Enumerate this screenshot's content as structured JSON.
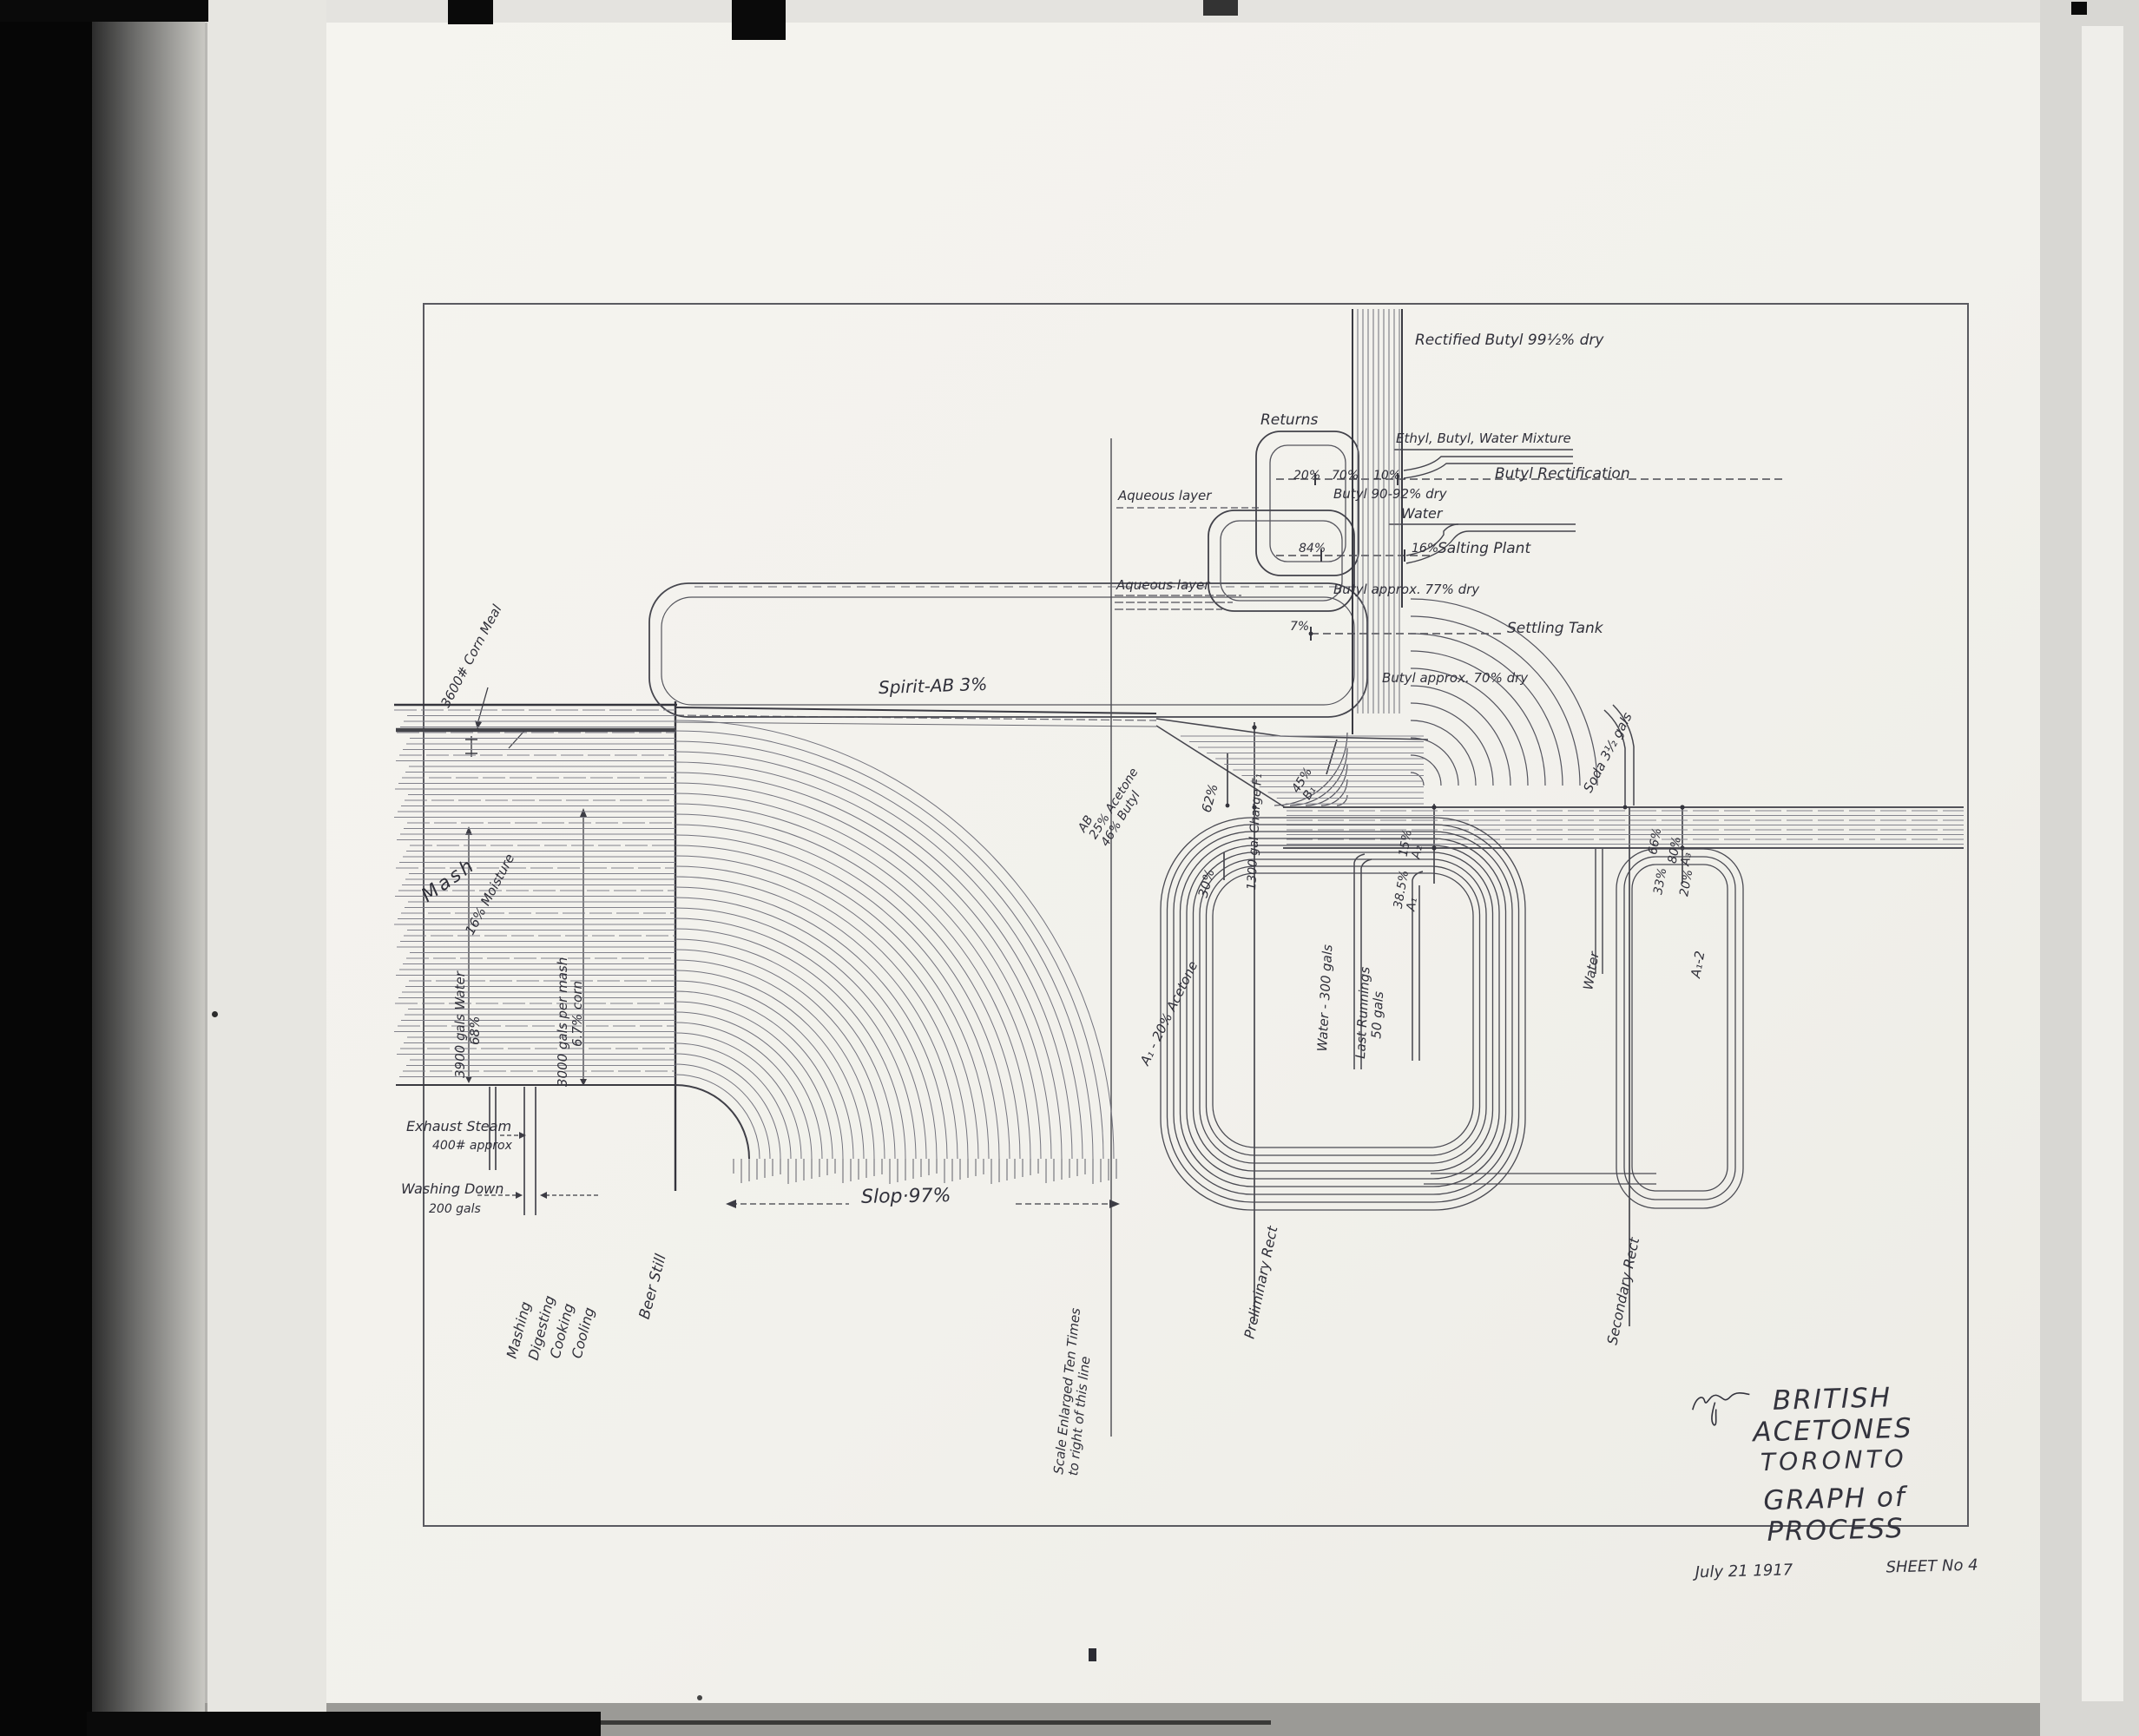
{
  "title_block": {
    "company": "BRITISH ACETONES",
    "city": "TORONTO",
    "title": "GRAPH of PROCESS",
    "date": "July 21 1917",
    "sheet": "SHEET No 4"
  },
  "left": {
    "mash": "Mash",
    "water_line1": "3900 gals Water",
    "water_line2": "68%",
    "corn_meal": "3600# Corn Meal",
    "moisture": "16% Moisture",
    "per_mash_line1": "3000 gals per mash",
    "per_mash_line2": "6.7% corn",
    "exhaust_line1": "Exhaust Steam",
    "exhaust_line2": "400# approx",
    "washing_line1": "Washing Down",
    "washing_line2": "200 gals",
    "process_steps": [
      "Mashing",
      "Digesting",
      "Cooking",
      "Cooling"
    ],
    "beer_still": "Beer Still",
    "slop": "Slop·97%",
    "spirit": "Spirit-AB 3%",
    "scale_line1": "Scale Enlarged Ten Times",
    "scale_line2": "to right of this line"
  },
  "preliminary": {
    "charge_ab_1": "AB",
    "charge_ab_2": "25% Acetone",
    "charge_ab_3": "46% Butyl",
    "pct_62": "62%",
    "charge": "1300 gal Charge F₁",
    "pct_30": "30%",
    "b1_pct": "45%",
    "b1": "B₁",
    "a2_pct": "15%",
    "a2": "A₂",
    "a1_pct": "38.5%",
    "a1": "A₁",
    "rect_label": "Preliminary Rect",
    "a1_acetone": "A₁ - 20% Acetone",
    "water_300": "Water - 300 gals",
    "last_runnings_1": "Last Runnings",
    "last_runnings_2": "50 gals"
  },
  "riser": {
    "rectified": "Rectified Butyl 99½% dry",
    "returns": "Returns",
    "ethyl_mix": "Ethyl, Butyl, Water Mixture",
    "pct_20": "20%",
    "pct_70": "70%",
    "pct_10": "10%",
    "butyl_rectification": "Butyl Rectification",
    "butyl_9092": "Butyl 90-92% dry",
    "water": "Water",
    "pct_84": "84%",
    "pct_16": "16%",
    "salting_plant": "Salting Plant",
    "aqueous_1": "Aqueous layer",
    "aqueous_2": "Aqueous layer",
    "butyl_77": "Butyl approx. 77% dry",
    "pct_7": "7%",
    "settling_tank": "Settling Tank",
    "butyl_70": "Butyl approx. 70% dry"
  },
  "secondary": {
    "soda": "Soda 3½ gals",
    "pct_66": "66%",
    "pct_33": "33%",
    "a3_pct": "80%",
    "a3": "A₃",
    "pct_20": "20%",
    "a12": "A₁-2",
    "water": "Water",
    "rect_label": "Secondary Rect"
  }
}
